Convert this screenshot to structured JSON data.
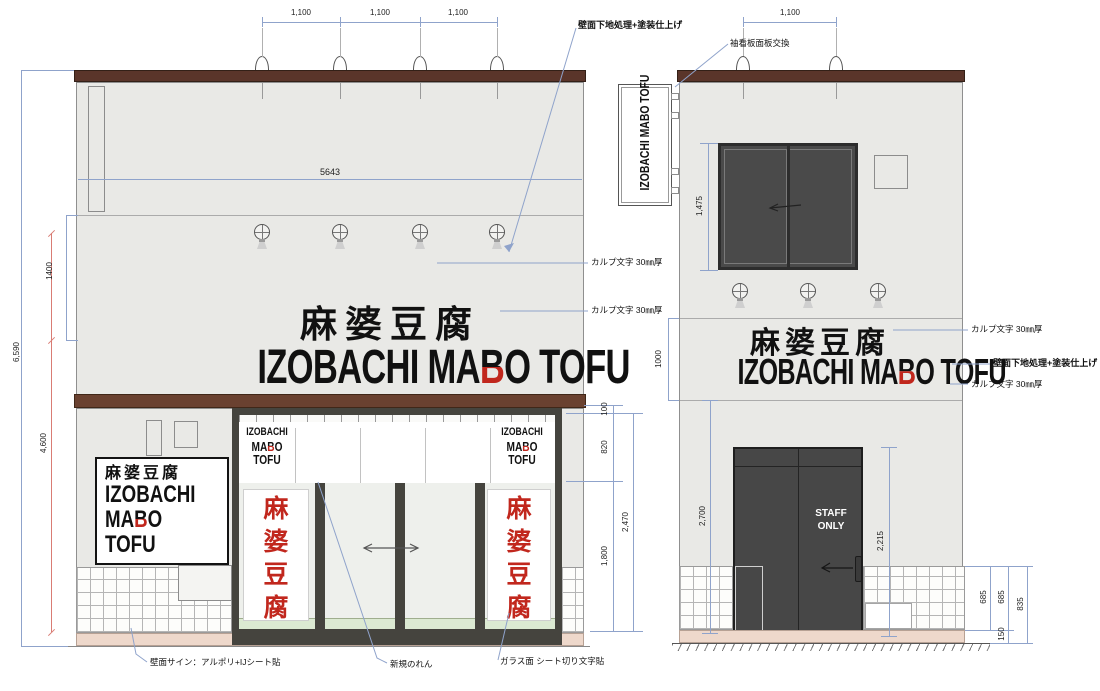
{
  "title": "IZOBACHI MABO TOFU storefront elevation drawing",
  "colors": {
    "wall": "#e9e9e6",
    "cap": "#5a352a",
    "band": "#6a4130",
    "frame": "#45443e",
    "red": "#c1271d",
    "base_pink": "#eed8cb",
    "glass": "#eef0ec",
    "glass_green": "#dcead2",
    "door": "#474747",
    "dim": "#8fa3cb",
    "dim_red": "#d97c74"
  },
  "logos": {
    "kanji": "麻婆豆腐",
    "latin_pre": "IZOBACHI MA",
    "latin_b": "B",
    "latin_post": "O TOFU",
    "stack_l1": "IZOBACHI",
    "stack_l2_pre": "MA",
    "stack_l2_b": "B",
    "stack_l2_post": "O",
    "stack_l3": "TOFU",
    "vertical_latin": "IZOBACHI MABO TOFU",
    "vertical_kanji": [
      "麻",
      "婆",
      "豆",
      "腐"
    ],
    "staff_l1": "STAFF",
    "staff_l2": "ONLY"
  },
  "dims": {
    "front_top": [
      "1,100",
      "1,100",
      "1,100"
    ],
    "side_top": "1,100",
    "front_width": "5643",
    "total_height": "6,590",
    "lower_height": "4,600",
    "band_height": "1400",
    "noren_top": "100",
    "noren_height": "820",
    "glass_height": "1,800",
    "opening_height": "2,470",
    "window_height": "1,475",
    "side_band_height": "1000",
    "door_height": "2,700",
    "door_sub": "2,215",
    "tile_a": "685",
    "tile_b": "685",
    "tile_total": "835",
    "base_height": "150"
  },
  "annotations": {
    "wall_finish": "壁面下地処理+塗装仕上げ",
    "sleeve_sign": "袖看板面板交換",
    "calp": "カルプ文字 30㎜厚",
    "wall_sign": "壁面サイン：アルポリ+IJシート貼",
    "new_noren": "新規のれん",
    "glass_sheet": "ガラス面 シート切り文字貼"
  }
}
